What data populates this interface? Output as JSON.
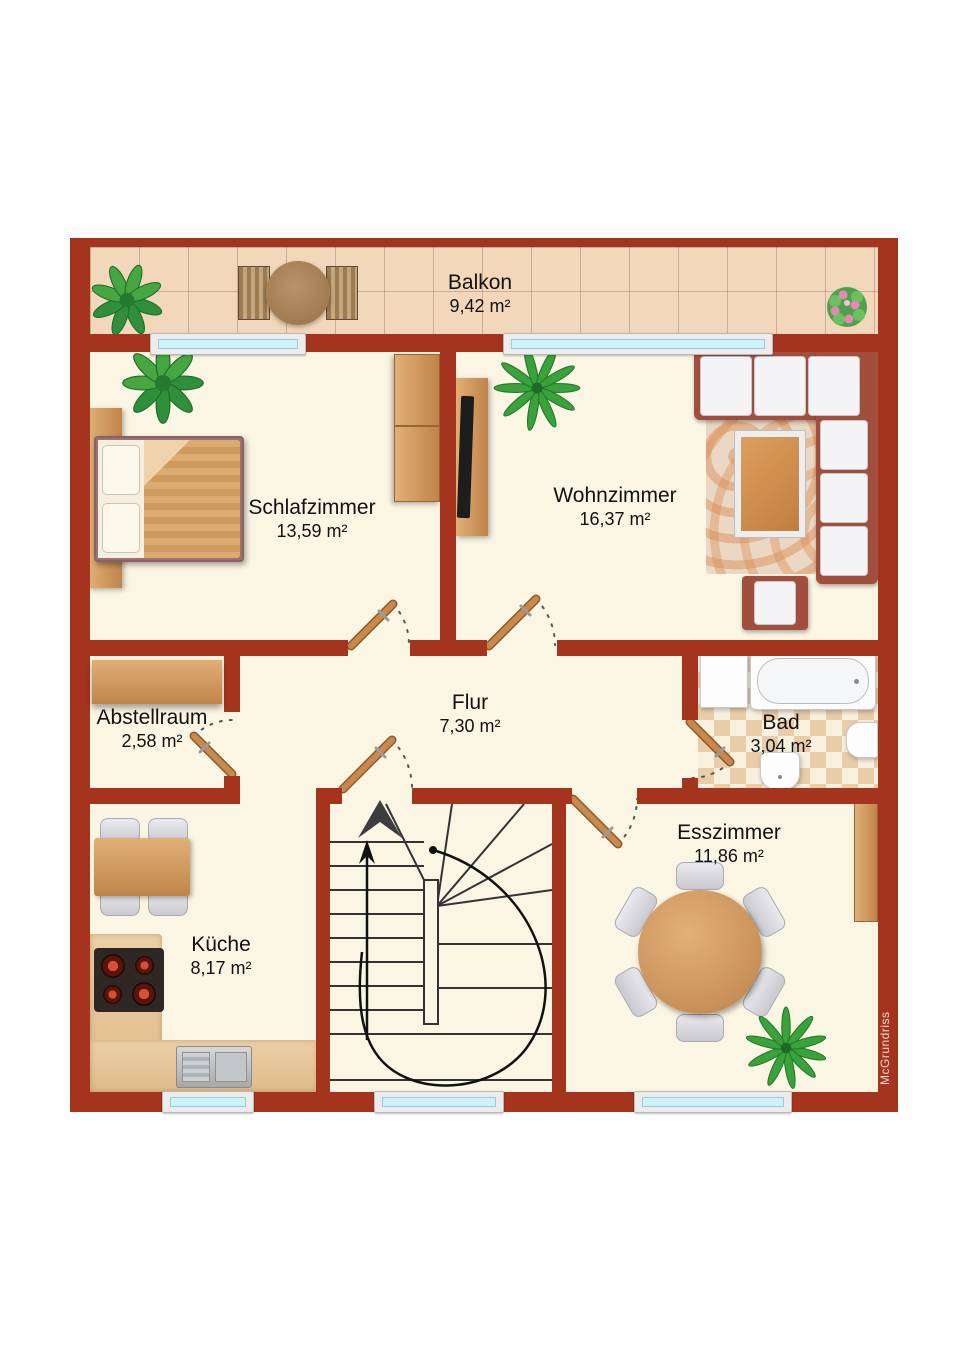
{
  "plan": {
    "watermark": "McGrundriss",
    "rooms": [
      {
        "name": "Balkon",
        "area": "9,42 m²"
      },
      {
        "name": "Schlafzimmer",
        "area": "13,59 m²"
      },
      {
        "name": "Wohnzimmer",
        "area": "16,37 m²"
      },
      {
        "name": "Flur",
        "area": "7,30 m²"
      },
      {
        "name": "Abstellraum",
        "area": "2,58 m²"
      },
      {
        "name": "Bad",
        "area": "3,04 m²"
      },
      {
        "name": "Esszimmer",
        "area": "11,86 m²"
      },
      {
        "name": "Küche",
        "area": "8,17 m²"
      }
    ],
    "colors": {
      "wall": "#a5341e",
      "floor": "#fbf5e3",
      "balcony_tile": "#f3d7ba",
      "window_glass": "#ccf2fa",
      "wood": "#c98f54"
    }
  }
}
